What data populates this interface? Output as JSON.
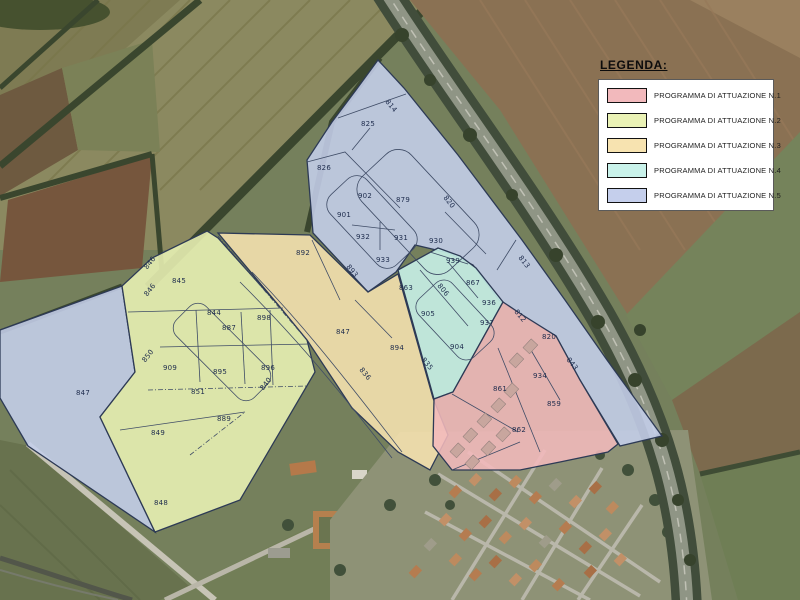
{
  "legend": {
    "title": "LEGENDA:"
  },
  "zones": [
    {
      "label": "PROGRAMMA DI ATTUAZIONE N.1",
      "color": "#f2b9bc",
      "parcels": [
        {
          "id": "812",
          "x": 520,
          "y": 316,
          "r": 50
        },
        {
          "id": "820",
          "x": 549,
          "y": 337
        },
        {
          "id": "934",
          "x": 540,
          "y": 376
        },
        {
          "id": "861",
          "x": 500,
          "y": 389
        },
        {
          "id": "859",
          "x": 554,
          "y": 404
        },
        {
          "id": "862",
          "x": 519,
          "y": 430
        }
      ]
    },
    {
      "label": "PROGRAMMA DI ATTUAZIONE N.2",
      "color": "#eaf2b5",
      "parcels": [
        {
          "id": "845",
          "x": 179,
          "y": 281
        },
        {
          "id": "846",
          "x": 150,
          "y": 263,
          "r": -52
        },
        {
          "id": "844",
          "x": 214,
          "y": 313
        },
        {
          "id": "887",
          "x": 229,
          "y": 328
        },
        {
          "id": "898",
          "x": 264,
          "y": 318
        },
        {
          "id": "850",
          "x": 148,
          "y": 356,
          "r": -52
        },
        {
          "id": "909",
          "x": 170,
          "y": 368
        },
        {
          "id": "895",
          "x": 220,
          "y": 372
        },
        {
          "id": "896",
          "x": 268,
          "y": 368
        },
        {
          "id": "840",
          "x": 266,
          "y": 384,
          "r": -52
        },
        {
          "id": "851",
          "x": 198,
          "y": 392
        },
        {
          "id": "889",
          "x": 224,
          "y": 419
        },
        {
          "id": "849",
          "x": 158,
          "y": 433
        },
        {
          "id": "848",
          "x": 161,
          "y": 503
        }
      ]
    },
    {
      "label": "PROGRAMMA DI ATTUAZIONE N.3",
      "color": "#f7e3b0",
      "parcels": [
        {
          "id": "892",
          "x": 303,
          "y": 253
        },
        {
          "id": "893",
          "x": 352,
          "y": 271,
          "r": 50
        },
        {
          "id": "847",
          "x": 343,
          "y": 332
        },
        {
          "id": "894",
          "x": 397,
          "y": 348
        },
        {
          "id": "836",
          "x": 365,
          "y": 374,
          "r": 50
        },
        {
          "id": "835",
          "x": 427,
          "y": 364,
          "r": 50
        }
      ]
    },
    {
      "label": "PROGRAMMA DI ATTUAZIONE N.4",
      "color": "#c9f2ea",
      "parcels": [
        {
          "id": "863",
          "x": 406,
          "y": 288
        },
        {
          "id": "806",
          "x": 443,
          "y": 290,
          "r": 50
        },
        {
          "id": "867",
          "x": 473,
          "y": 283
        },
        {
          "id": "936",
          "x": 489,
          "y": 303
        },
        {
          "id": "905",
          "x": 428,
          "y": 314
        },
        {
          "id": "937",
          "x": 487,
          "y": 323
        },
        {
          "id": "904",
          "x": 457,
          "y": 347
        }
      ]
    },
    {
      "label": "PROGRAMMA DI ATTUAZIONE N.5",
      "color": "#c5cfec",
      "parcels": [
        {
          "id": "814",
          "x": 391,
          "y": 106,
          "r": 50
        },
        {
          "id": "825",
          "x": 368,
          "y": 124
        },
        {
          "id": "826",
          "x": 324,
          "y": 168
        },
        {
          "id": "902",
          "x": 365,
          "y": 196
        },
        {
          "id": "879",
          "x": 403,
          "y": 200
        },
        {
          "id": "901",
          "x": 344,
          "y": 215
        },
        {
          "id": "820",
          "x": 449,
          "y": 202,
          "r": 52
        },
        {
          "id": "932",
          "x": 363,
          "y": 237
        },
        {
          "id": "931",
          "x": 401,
          "y": 238
        },
        {
          "id": "930",
          "x": 436,
          "y": 241
        },
        {
          "id": "933",
          "x": 383,
          "y": 260
        },
        {
          "id": "939",
          "x": 453,
          "y": 261
        },
        {
          "id": "813",
          "x": 524,
          "y": 262,
          "r": 52
        },
        {
          "id": "846",
          "x": 150,
          "y": 290,
          "r": -52
        },
        {
          "id": "847",
          "x": 83,
          "y": 393
        },
        {
          "id": "843",
          "x": 572,
          "y": 364,
          "r": 52
        }
      ]
    }
  ]
}
